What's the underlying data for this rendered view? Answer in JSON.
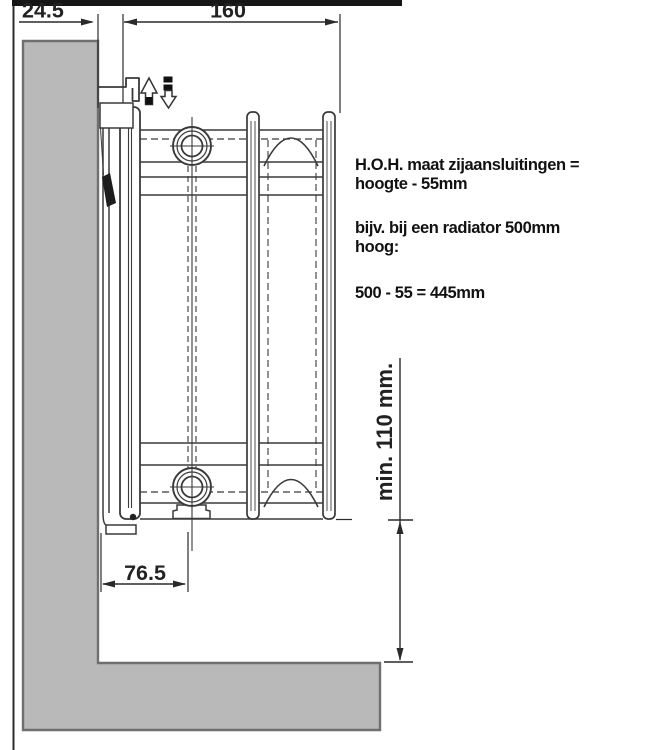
{
  "diagram": {
    "type": "radiator-side-mounting-technical-drawing",
    "colors": {
      "background": "#ffffff",
      "wall_fill": "#b9b9b9",
      "wall_stroke": "#6f6f6f",
      "line": "#3a3a3a",
      "top_bar": "#161616",
      "text": "#111111"
    },
    "icons": {
      "up": "arrow-up",
      "down": "arrow-down"
    },
    "dimensions": {
      "wall_offset": "24.5",
      "bracket_depth": "160",
      "pipe_offset": "76.5",
      "min_floor_clearance": "min. 110 mm."
    },
    "notes": {
      "line1": "H.O.H. maat zijaansluitingen =",
      "line2": "hoogte - 55mm",
      "line3": "bijv. bij een radiator 500mm",
      "line4": "hoog:",
      "line5": "500 - 55 = 445mm"
    }
  }
}
